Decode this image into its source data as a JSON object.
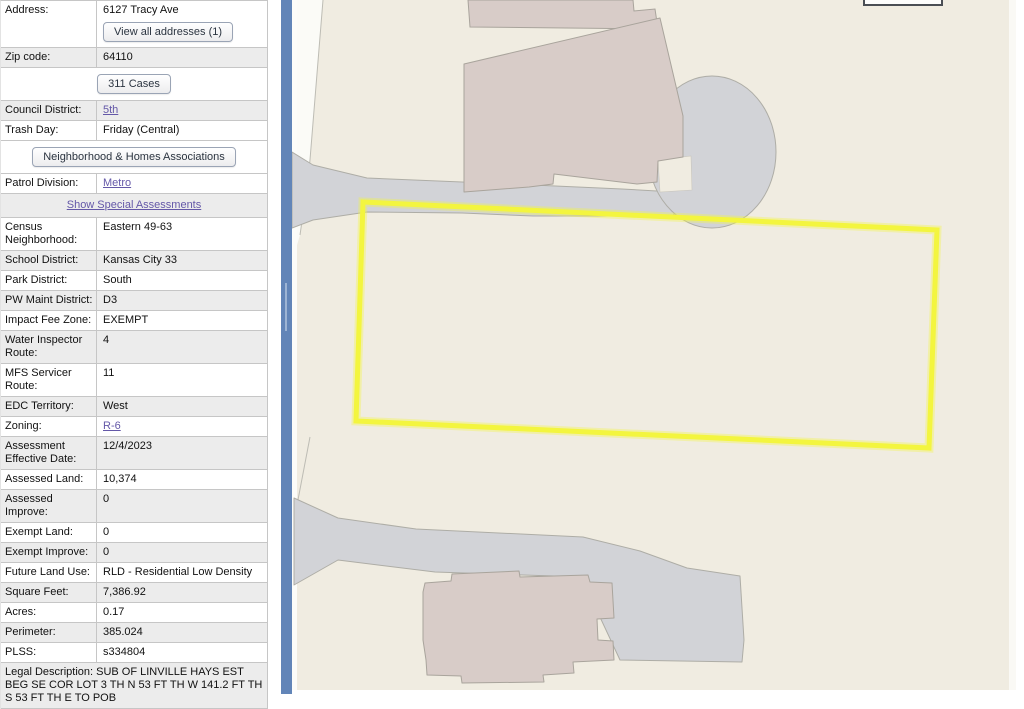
{
  "panel": {
    "rows": [
      {
        "id": "address",
        "type": "field",
        "label": "Address:",
        "value": "6127 Tracy Ave",
        "button": "View all addresses (1)",
        "button_id": "view-all-addresses-button",
        "bg": "white"
      },
      {
        "id": "zip-code",
        "type": "field",
        "label": "Zip code:",
        "value": "64110",
        "bg": "gray"
      },
      {
        "id": "cases-311",
        "type": "button",
        "label": "311 Cases",
        "bg": "white"
      },
      {
        "id": "council-district",
        "type": "field",
        "label": "Council District:",
        "value": "5th",
        "link": true,
        "bg": "gray"
      },
      {
        "id": "trash-day",
        "type": "field",
        "label": "Trash Day:",
        "value": "Friday (Central)",
        "bg": "white"
      },
      {
        "id": "neighborhood-homes-associations",
        "type": "button",
        "label": "Neighborhood & Homes Associations",
        "bg": "white"
      },
      {
        "id": "patrol-division",
        "type": "field",
        "label": "Patrol Division:",
        "value": "Metro",
        "link": true,
        "bg": "white"
      },
      {
        "id": "show-special-assessments",
        "type": "link-row",
        "label": "Show Special Assessments",
        "bg": "gray"
      },
      {
        "id": "census-neighborhood",
        "type": "field",
        "label": "Census Neighborhood:",
        "value": "Eastern 49-63",
        "bg": "white"
      },
      {
        "id": "school-district",
        "type": "field",
        "label": "School District:",
        "value": "Kansas City 33",
        "bg": "gray"
      },
      {
        "id": "park-district",
        "type": "field",
        "label": "Park District:",
        "value": "South",
        "bg": "white"
      },
      {
        "id": "pw-maint-district",
        "type": "field",
        "label": "PW Maint District:",
        "value": "D3",
        "bg": "gray"
      },
      {
        "id": "impact-fee-zone",
        "type": "field",
        "label": "Impact Fee Zone:",
        "value": "EXEMPT",
        "bg": "white"
      },
      {
        "id": "water-inspector-route",
        "type": "field",
        "label": "Water Inspector Route:",
        "value": "4",
        "bg": "gray"
      },
      {
        "id": "mfs-servicer-route",
        "type": "field",
        "label": "MFS Servicer Route:",
        "value": "11",
        "bg": "white"
      },
      {
        "id": "edc-territory",
        "type": "field",
        "label": "EDC Territory:",
        "value": "West",
        "bg": "gray"
      },
      {
        "id": "zoning",
        "type": "field",
        "label": "Zoning:",
        "value": "R-6",
        "link": true,
        "bg": "white"
      },
      {
        "id": "assessment-effective-date",
        "type": "field",
        "label": "Assessment Effective Date:",
        "value": "12/4/2023",
        "bg": "gray"
      },
      {
        "id": "assessed-land",
        "type": "field",
        "label": "Assessed Land:",
        "value": "10,374",
        "bg": "white"
      },
      {
        "id": "assessed-improve",
        "type": "field",
        "label": "Assessed Improve:",
        "value": "0",
        "bg": "gray"
      },
      {
        "id": "exempt-land",
        "type": "field",
        "label": "Exempt Land:",
        "value": "0",
        "bg": "white"
      },
      {
        "id": "exempt-improve",
        "type": "field",
        "label": "Exempt Improve:",
        "value": "0",
        "bg": "gray"
      },
      {
        "id": "future-land-use",
        "type": "field",
        "label": "Future Land Use:",
        "value": "RLD - Residential Low Density",
        "bg": "white"
      },
      {
        "id": "square-feet",
        "type": "field",
        "label": "Square Feet:",
        "value": "7,386.92",
        "bg": "gray"
      },
      {
        "id": "acres",
        "type": "field",
        "label": "Acres:",
        "value": "0.17",
        "bg": "white"
      },
      {
        "id": "perimeter",
        "type": "field",
        "label": "Perimeter:",
        "value": "385.024",
        "bg": "gray"
      },
      {
        "id": "plss",
        "type": "field",
        "label": "PLSS:",
        "value": "s334804",
        "bg": "white"
      },
      {
        "id": "legal-description",
        "type": "text",
        "label": "Legal Description: SUB OF LINVILLE HAYS EST BEG SE COR LOT 3 TH N 53 FT TH W 141.2 FT TH S 53 FT TH E TO POB",
        "bg": "gray"
      }
    ]
  },
  "map": {
    "selected_parcel_address": "6127 Tracy Ave",
    "colors": {
      "splitter": "#6285b8",
      "map_bg": "#f0ece1",
      "road": "#d2d3d7",
      "road_edge": "#aeada6",
      "building": "#d8ccc8",
      "building_edge": "#a9a49c",
      "parcel_highlight": "#f3f53f",
      "row_alt": "#ececec",
      "row_border": "#c6c6c6",
      "link": "#6458a8"
    }
  }
}
